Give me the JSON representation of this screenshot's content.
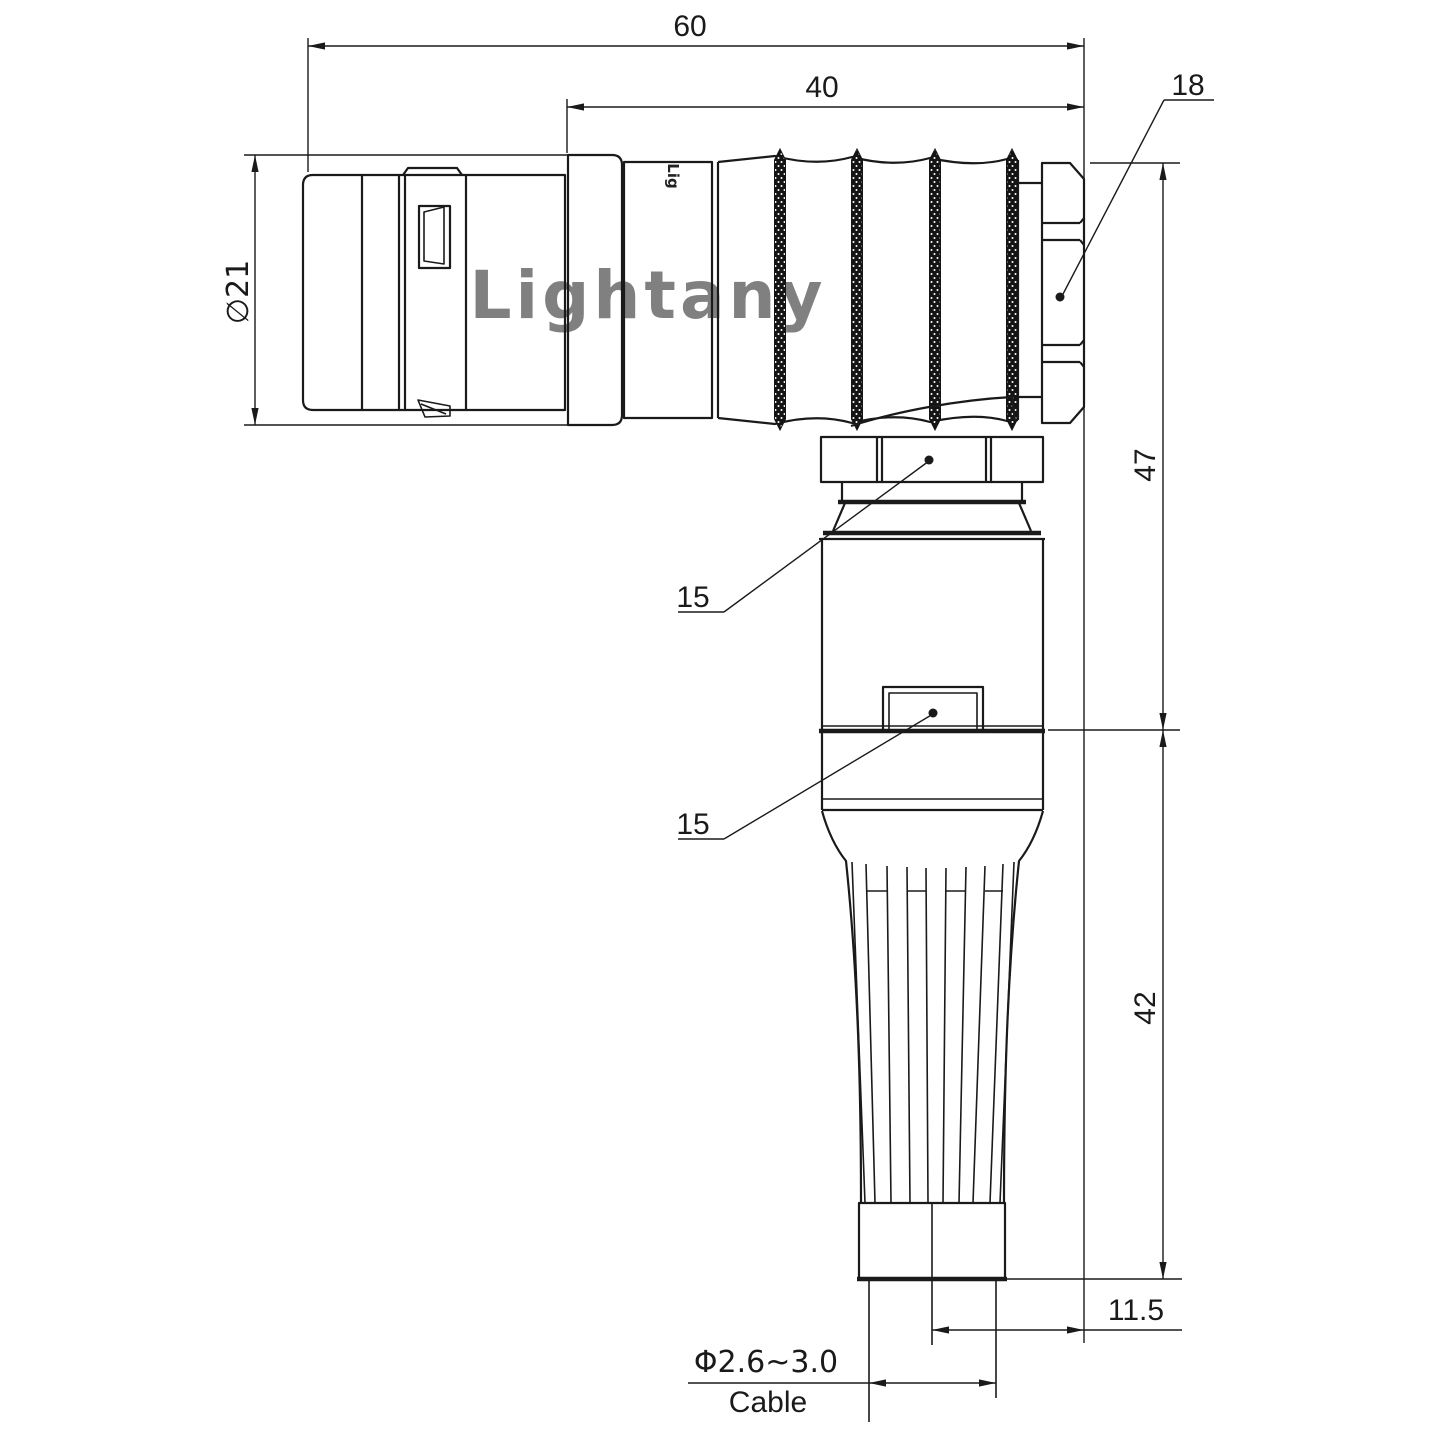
{
  "drawing": {
    "watermark": "Lightany",
    "body_logo": "Lig",
    "dimensions": {
      "overall_length": "60",
      "rear_length": "40",
      "nut_size": "18",
      "shell_diameter": "∅21",
      "height_upper": "47",
      "height_lower": "42",
      "axis_offset": "11.5",
      "collar_callout": "15",
      "boss_callout": "15",
      "cable_diameter": "Φ2.6~3.0",
      "cable_label": "Cable"
    },
    "colors": {
      "line": "#1a1a1a",
      "watermark": "#f0c2c2",
      "background": "#ffffff"
    }
  }
}
